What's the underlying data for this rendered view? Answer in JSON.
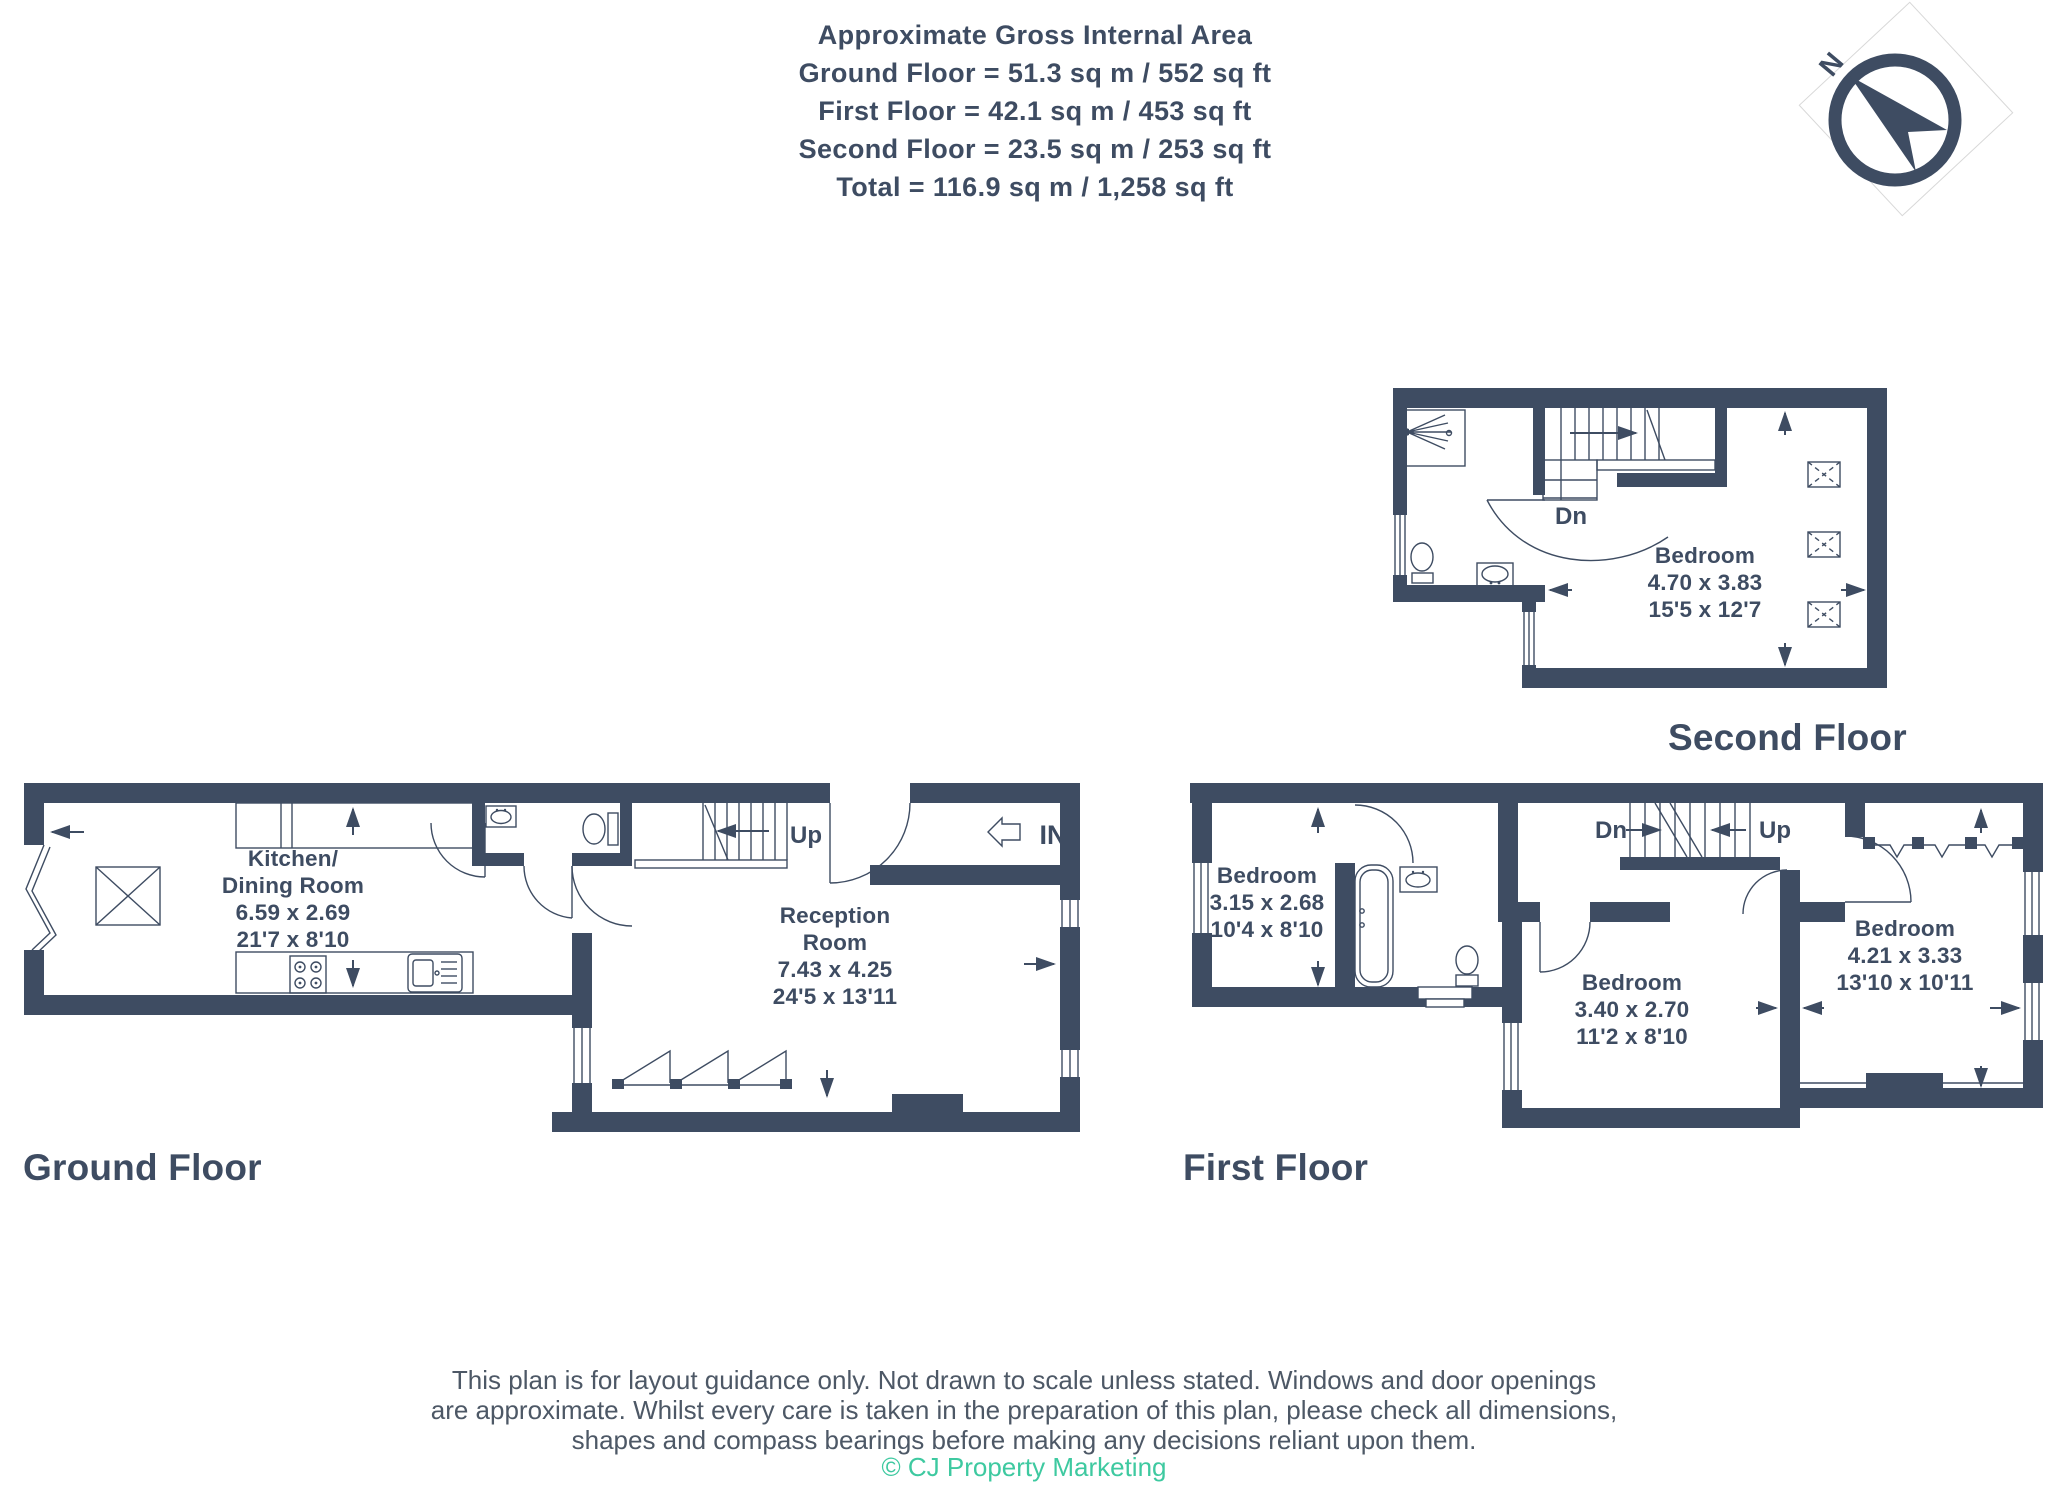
{
  "header": {
    "title": "Approximate Gross Internal Area",
    "lines": [
      "Ground Floor = 51.3 sq m / 552 sq ft",
      "First Floor = 42.1 sq m / 453 sq ft",
      "Second Floor = 23.5 sq m / 253 sq ft",
      "Total = 116.9 sq m / 1,258 sq ft"
    ]
  },
  "compass": {
    "north_label": "N"
  },
  "colors": {
    "navy": "#3e4c62",
    "teal": "#3ec9a0",
    "disclaimer_gray": "#4d5866"
  },
  "floors": {
    "ground": {
      "label": "Ground Floor",
      "stairs_label": "Up",
      "entrance_label": "IN",
      "rooms": {
        "kitchen": {
          "name_line1": "Kitchen/",
          "name_line2": "Dining Room",
          "metric": "6.59 x 2.69",
          "imperial": "21'7 x 8'10"
        },
        "reception": {
          "name_line1": "Reception",
          "name_line2": "Room",
          "metric": "7.43 x 4.25",
          "imperial": "24'5 x 13'11"
        }
      }
    },
    "first": {
      "label": "First Floor",
      "stairs_down_label": "Dn",
      "stairs_up_label": "Up",
      "rooms": {
        "bedroom_front": {
          "name": "Bedroom",
          "metric": "3.15 x 2.68",
          "imperial": "10'4 x 8'10"
        },
        "bedroom_middle": {
          "name": "Bedroom",
          "metric": "3.40 x 2.70",
          "imperial": "11'2 x 8'10"
        },
        "bedroom_rear": {
          "name": "Bedroom",
          "metric": "4.21 x 3.33",
          "imperial": "13'10 x 10'11"
        }
      }
    },
    "second": {
      "label": "Second Floor",
      "stairs_label": "Dn",
      "rooms": {
        "bedroom": {
          "name": "Bedroom",
          "metric": "4.70 x 3.83",
          "imperial": "15'5 x 12'7"
        }
      }
    }
  },
  "footer": {
    "disclaimer_lines": [
      "This plan is for layout guidance only. Not drawn to scale unless stated. Windows and door openings",
      "are approximate. Whilst every care is taken in the preparation of this plan, please check all dimensions,",
      "shapes and compass bearings before making any decisions reliant upon them."
    ],
    "copyright": "© CJ Property Marketing"
  }
}
